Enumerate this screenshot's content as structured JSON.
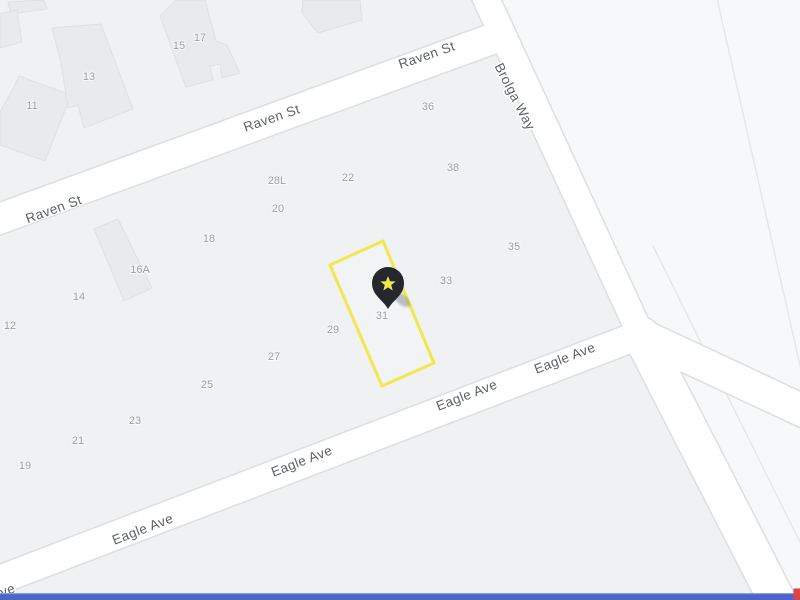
{
  "map": {
    "canvas": {
      "width": 800,
      "height": 600
    },
    "colors": {
      "background": "#f0f1f3",
      "ne_region": "#f7f8f9",
      "road_fill": "#ffffff",
      "road_casing": "#dcdee1",
      "building_fill": "#e9eaec",
      "building_stroke": "#dfe0e3",
      "faint_line": "#e4e6e9",
      "street_label": "#5d6268",
      "parcel_number": "#9aa0a7",
      "highlight": "#f0e84e",
      "highlight_fill_opacity": 0.18,
      "pin": "#26262e",
      "pin_star": "#f0e84e",
      "bottom_bar": "#4b65c9",
      "bottom_bar_edge": "#8b9cdf",
      "corner_marker": "#e24444"
    },
    "streets": [
      {
        "name": "Raven St",
        "width": 30,
        "path": [
          [
            -12,
            223
          ],
          [
            500,
            36
          ]
        ],
        "labels": [
          {
            "text": "Raven St",
            "x": 54,
            "y": 210,
            "rotate": -20
          },
          {
            "text": "Raven St",
            "x": 272,
            "y": 119,
            "rotate": -19
          },
          {
            "text": "Raven St",
            "x": 427,
            "y": 56,
            "rotate": -19
          }
        ]
      },
      {
        "name": "Brolga Way",
        "width": 26,
        "path": [
          [
            483,
            -8
          ],
          [
            641,
            335
          ]
        ],
        "labels": [
          {
            "text": "Brolga Way",
            "x": 514,
            "y": 97,
            "rotate": 63
          }
        ]
      },
      {
        "name": "Eagle Ave",
        "width": 28,
        "path": [
          [
            -14,
            585
          ],
          [
            642,
            334
          ]
        ],
        "labels": [
          {
            "text": "ve",
            "x": 8,
            "y": 591,
            "rotate": -21
          },
          {
            "text": "Eagle Ave",
            "x": 143,
            "y": 530,
            "rotate": -21
          },
          {
            "text": "Eagle Ave",
            "x": 302,
            "y": 462,
            "rotate": -21
          },
          {
            "text": "Eagle Ave",
            "x": 467,
            "y": 396,
            "rotate": -21
          },
          {
            "text": "Eagle Ave",
            "x": 565,
            "y": 359,
            "rotate": -21
          }
        ]
      },
      {
        "name": "",
        "width": 32,
        "path": [
          [
            641,
            335
          ],
          [
            812,
            415
          ]
        ],
        "labels": []
      },
      {
        "name": "",
        "width": 36,
        "path": [
          [
            641,
            335
          ],
          [
            784,
            614
          ]
        ],
        "labels": []
      }
    ],
    "ne_region_polygon": [
      [
        493,
        -12
      ],
      [
        822,
        -12
      ],
      [
        822,
        622
      ],
      [
        797,
        622
      ],
      [
        652,
        341
      ]
    ],
    "faint_lines": [
      {
        "d": "M716,-6 Q758,178 801,370"
      },
      {
        "d": "M653,246 L803,548"
      }
    ],
    "buildings": [
      {
        "id": "building-a",
        "points": [
          [
            8,
            2
          ],
          [
            44,
            0
          ],
          [
            47,
            9
          ],
          [
            11,
            14
          ]
        ]
      },
      {
        "id": "building-b",
        "points": [
          [
            0,
            14
          ],
          [
            17,
            10
          ],
          [
            22,
            42
          ],
          [
            0,
            48
          ]
        ]
      },
      {
        "id": "building-11",
        "points": [
          [
            19,
            76
          ],
          [
            71,
            95
          ],
          [
            45,
            161
          ],
          [
            0,
            145
          ],
          [
            0,
            112
          ],
          [
            13,
            89
          ]
        ]
      },
      {
        "id": "building-13",
        "points": [
          [
            52,
            28
          ],
          [
            101,
            24
          ],
          [
            133,
            109
          ],
          [
            84,
            128
          ],
          [
            78,
            105
          ],
          [
            68,
            108
          ],
          [
            61,
            62
          ]
        ]
      },
      {
        "id": "building-15-17",
        "points": [
          [
            160,
            16
          ],
          [
            176,
            0
          ],
          [
            205,
            0
          ],
          [
            216,
            41
          ],
          [
            227,
            45
          ],
          [
            240,
            73
          ],
          [
            222,
            78
          ],
          [
            220,
            64
          ],
          [
            210,
            66
          ],
          [
            213,
            80
          ],
          [
            186,
            87
          ]
        ]
      },
      {
        "id": "building-top",
        "points": [
          [
            303,
            0
          ],
          [
            360,
            0
          ],
          [
            362,
            20
          ],
          [
            318,
            33
          ],
          [
            302,
            13
          ]
        ]
      },
      {
        "id": "building-16a",
        "points": [
          [
            94,
            229
          ],
          [
            118,
            219
          ],
          [
            152,
            288
          ],
          [
            124,
            301
          ]
        ]
      }
    ],
    "parcel_numbers": [
      {
        "text": "11",
        "x": 32,
        "y": 106
      },
      {
        "text": "13",
        "x": 89,
        "y": 77
      },
      {
        "text": "15",
        "x": 179,
        "y": 46
      },
      {
        "text": "17",
        "x": 200,
        "y": 38
      },
      {
        "text": "36",
        "x": 428,
        "y": 107
      },
      {
        "text": "38",
        "x": 453,
        "y": 168
      },
      {
        "text": "22",
        "x": 348,
        "y": 178
      },
      {
        "text": "28L",
        "x": 277,
        "y": 181
      },
      {
        "text": "20",
        "x": 278,
        "y": 209
      },
      {
        "text": "18",
        "x": 209,
        "y": 239
      },
      {
        "text": "16A",
        "x": 140,
        "y": 270
      },
      {
        "text": "14",
        "x": 79,
        "y": 297
      },
      {
        "text": "12",
        "x": 10,
        "y": 326
      },
      {
        "text": "35",
        "x": 514,
        "y": 247
      },
      {
        "text": "33",
        "x": 446,
        "y": 281
      },
      {
        "text": "31",
        "x": 382,
        "y": 316
      },
      {
        "text": "29",
        "x": 333,
        "y": 330
      },
      {
        "text": "27",
        "x": 274,
        "y": 357
      },
      {
        "text": "25",
        "x": 207,
        "y": 385
      },
      {
        "text": "23",
        "x": 135,
        "y": 421
      },
      {
        "text": "21",
        "x": 78,
        "y": 441
      },
      {
        "text": "19",
        "x": 25,
        "y": 466
      }
    ],
    "highlight": {
      "parcel_number": "31",
      "polygon": [
        [
          383,
          241
        ],
        [
          434,
          363
        ],
        [
          382,
          386
        ],
        [
          330,
          265
        ]
      ],
      "stroke_width": 3
    },
    "pin": {
      "x": 388,
      "y": 283,
      "radius": 16,
      "tip_y": 309,
      "star_outer": 8,
      "star_inner": 3.4
    },
    "bottom_bar": {
      "y": 594,
      "height": 6
    },
    "corner_marker": {
      "x": 793.5,
      "y": 588.5,
      "width": 6.5,
      "height": 11
    }
  }
}
